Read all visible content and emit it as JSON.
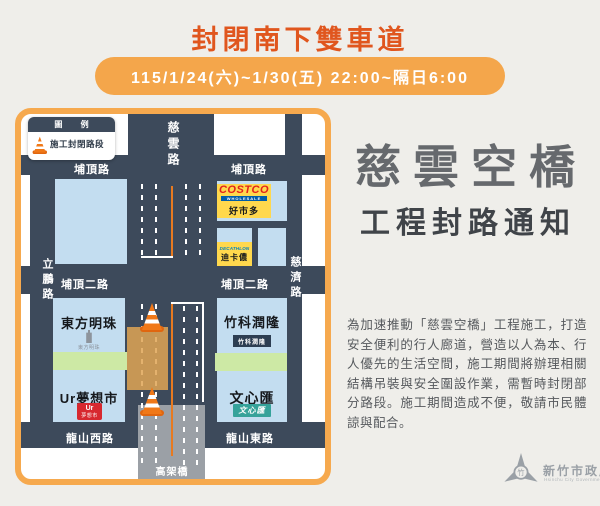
{
  "header": {
    "title": "封閉南下雙車道",
    "schedule": "115/1/24(六)~1/30(五)  22:00~隔日6:00"
  },
  "notice": {
    "title_main": "慈雲空橋",
    "title_sub": "工程封路通知",
    "body": "為加速推動「慈雲空橋」工程施工，打造安全便利的行人廊道，營造以人為本、行人優先的生活空間，施工期間將辦理相關結構吊裝與安全圍設作業，需暫時封閉部分路段。施工期間造成不便，敬請市民體諒與配合。"
  },
  "legend": {
    "header": "圖 例",
    "item": "施工封閉路段"
  },
  "map": {
    "roads": {
      "ciyun_rd": "慈雲路",
      "puding_rd_left": "埔頂路",
      "puding_rd_right": "埔頂路",
      "puding_2nd_rd_left": "埔頂二路",
      "puding_2nd_rd_right": "埔頂二路",
      "longshan_w_rd": "龍山西路",
      "longshan_e_rd": "龍山東路",
      "lipeng_rd": "立鵬路",
      "ciji_rd": "慈濟路",
      "viaduct": "高架橋"
    },
    "places": {
      "costco_wordmark": "COSTCO",
      "costco_wholesale": "WHOLESALE",
      "costco_cn": "好市多",
      "decathlon_wordmark": "DECATHLON",
      "decathlon_cn": "迪卡儂",
      "oriental_pearl": "東方明珠",
      "oriental_pearl_logo": "東方明珠",
      "ur_market": "Ur夢想市",
      "ur_logo_top": "Ur",
      "ur_logo_bottom": "夢想市",
      "zhuke_runlong": "竹科潤隆",
      "zhuke_runlong_logo": "竹科潤隆",
      "wenxin_hui": "文心匯",
      "wenxin_hui_logo": "文心匯"
    }
  },
  "footer": {
    "gov_name": "新竹市政府",
    "gov_name_en": "Hsinchu City Government"
  },
  "colors": {
    "accent_orange": "#f4a64b",
    "title_red": "#e0561e",
    "road_navy": "#3d4a5b",
    "block_blue": "#c3ddf0",
    "closure_tan": "#dfa555",
    "viaduct_gray": "#9ba0a6",
    "lane_orange": "#e87a20"
  }
}
